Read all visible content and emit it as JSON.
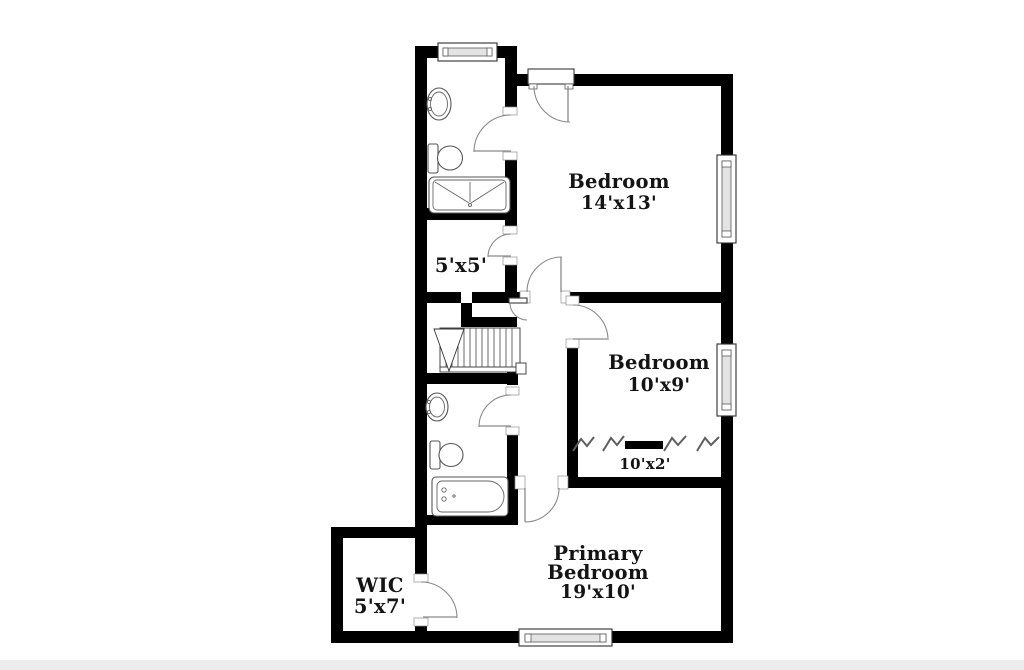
{
  "page": {
    "background_color": "#ffffff",
    "bottom_edge_band_color": "#ececec"
  },
  "plan": {
    "wall_color": "#000000",
    "door_arc_color": "#8a8a8a",
    "fixture_line_color": "#555555",
    "label_color": "#141414",
    "rooms": {
      "bedroom1": {
        "label": "Bedroom",
        "dims": "14'x13'"
      },
      "bedroom2": {
        "label": "Bedroom",
        "dims": "10'x9'"
      },
      "bedroom2_closet": {
        "dims": "10'x2'"
      },
      "primary_bedroom": {
        "label_line1": "Primary",
        "label_line2": "Bedroom",
        "dims": "19'x10'"
      },
      "hall_closet": {
        "dims": "5'x5'"
      },
      "wic": {
        "label": "WIC",
        "dims": "5'x7'"
      }
    },
    "fixture_icons": [
      "sink-icon",
      "toilet-icon",
      "shower-icon",
      "bathtub-icon",
      "stairs",
      "closet-rod-icon",
      "hanger-icon",
      "window",
      "door-swing"
    ]
  }
}
